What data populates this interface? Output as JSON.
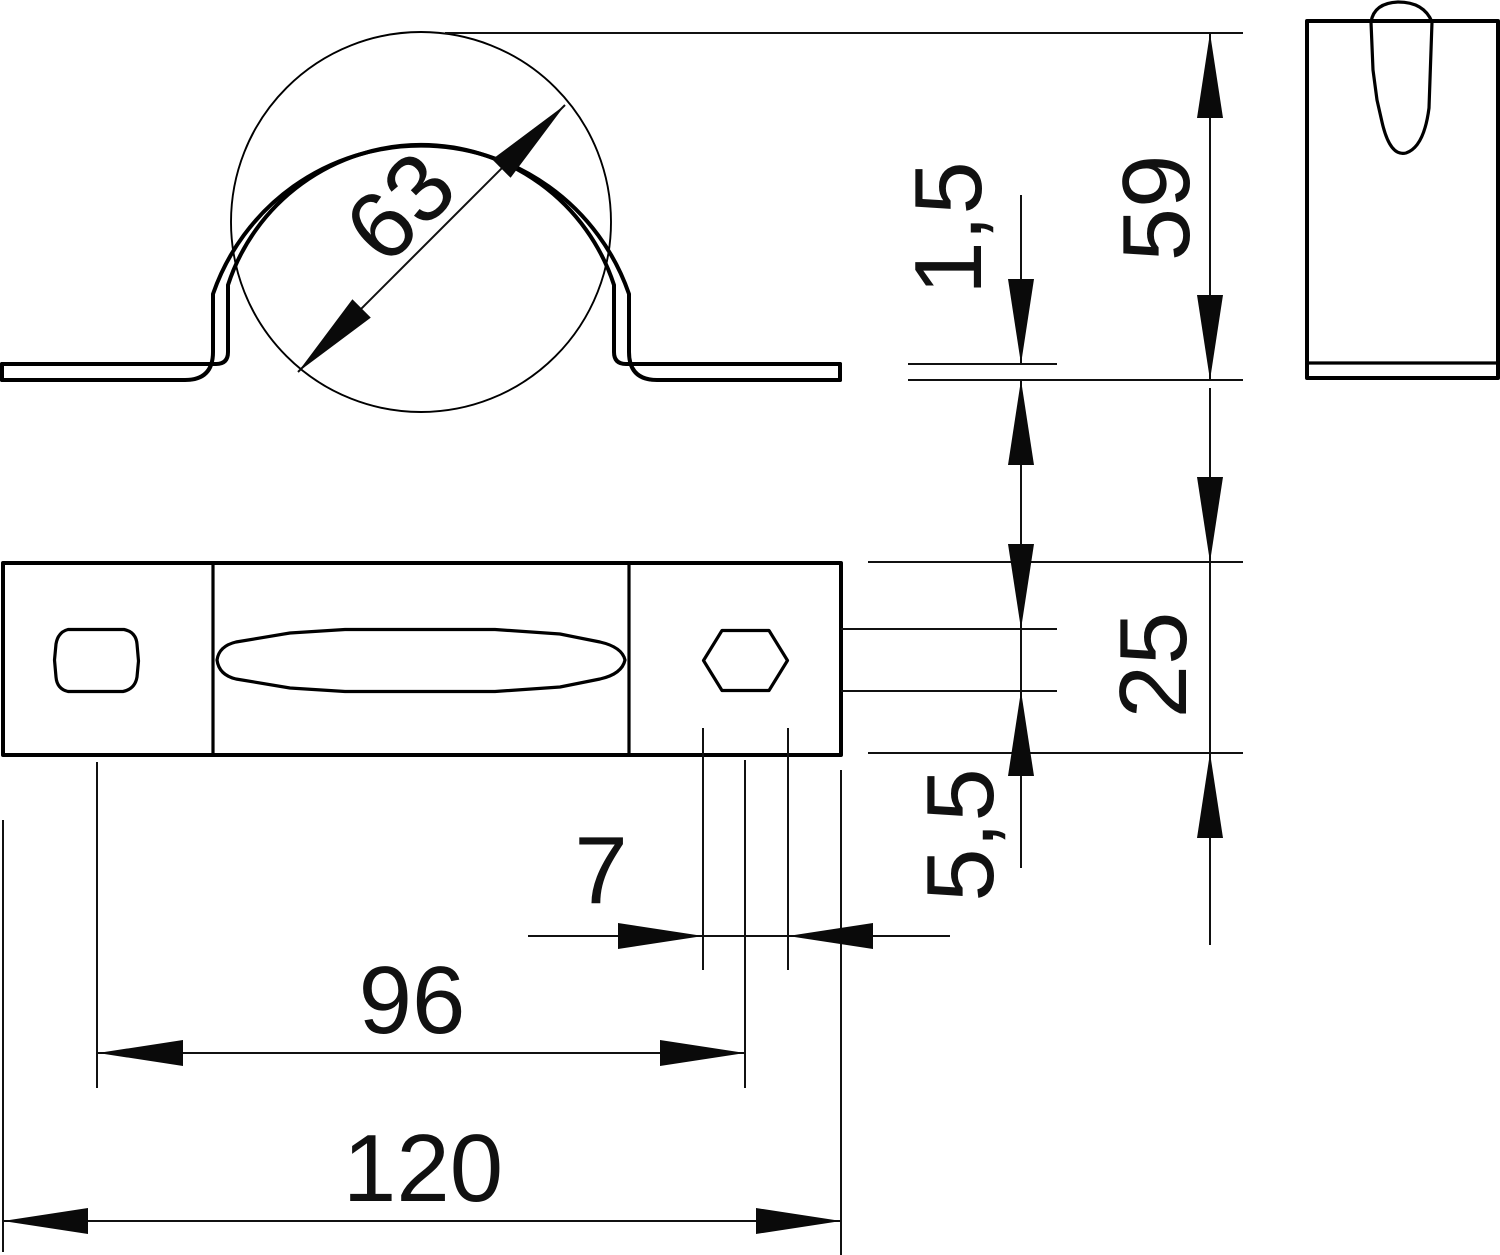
{
  "drawing": {
    "type": "technical-dimension-drawing",
    "part": "pipe saddle clamp",
    "views": {
      "front_view": "clamp with pipe circle",
      "top_view": "base plate with two screw holes and central slot",
      "side_view": "clamp profile with keyhole slot"
    },
    "colors": {
      "line": "#000000",
      "text": "#111111",
      "background": "#ffffff"
    }
  },
  "dimensions": {
    "pipe_diameter": "63",
    "material_thickness": "1,5",
    "clamp_height": "59",
    "base_width": "25",
    "hole_height": "5,5",
    "hole_width": "7",
    "hole_spacing": "96",
    "overall_length": "120"
  }
}
